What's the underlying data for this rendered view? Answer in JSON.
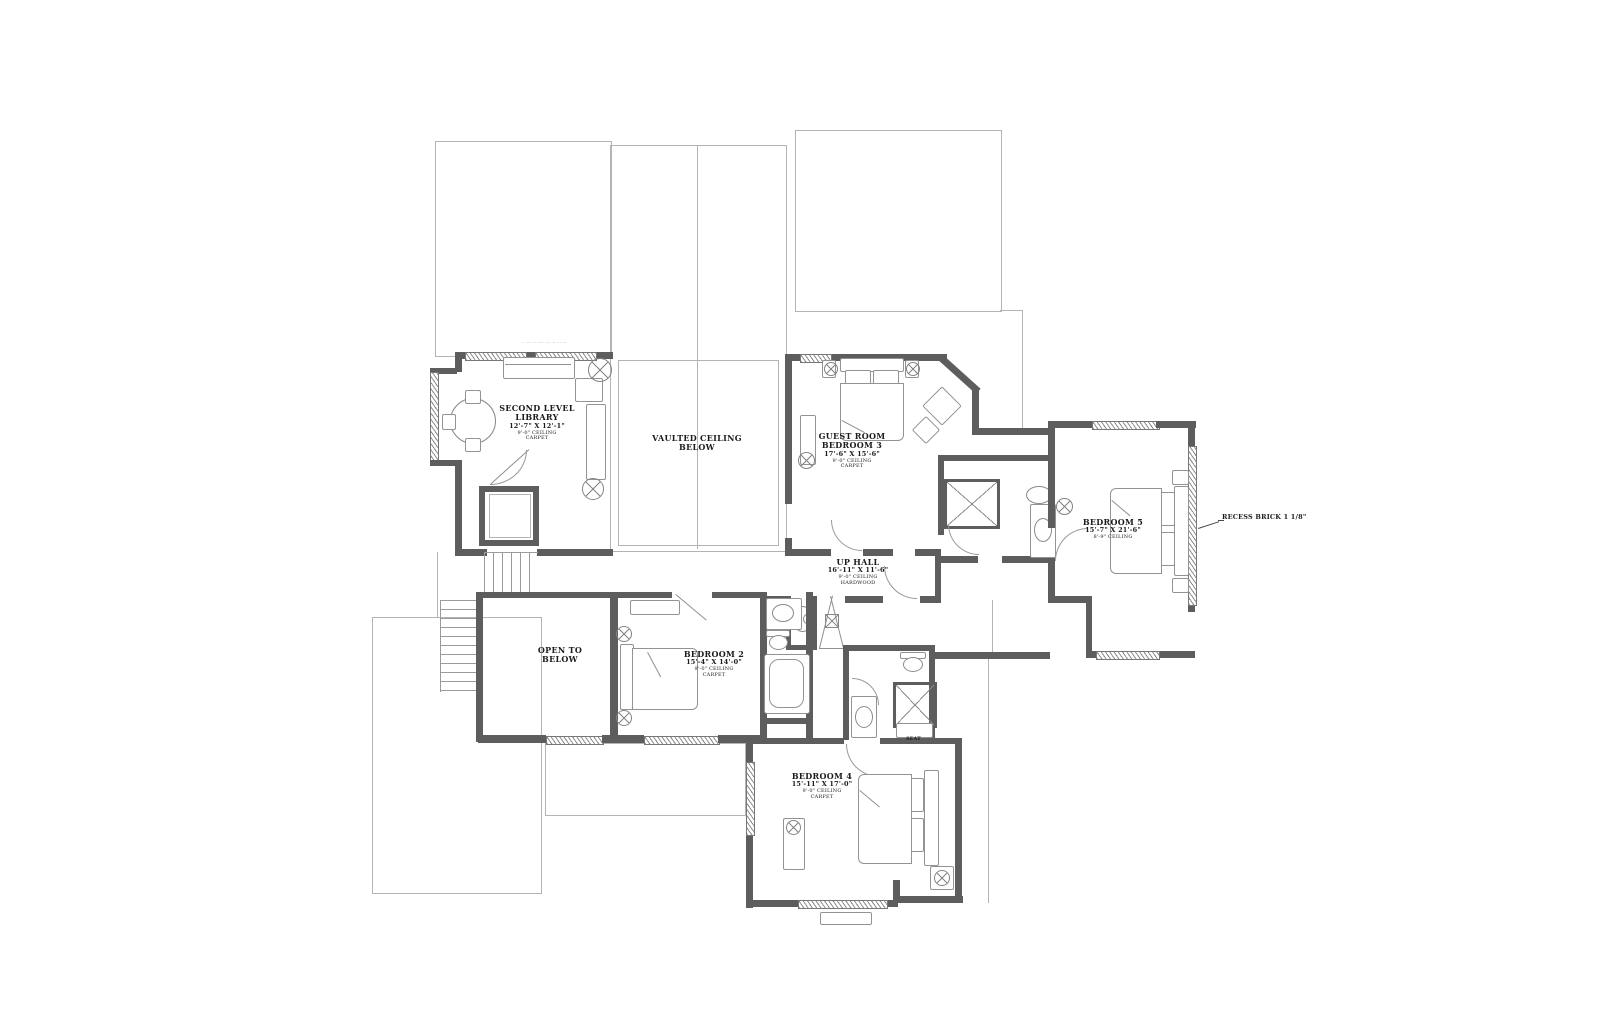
{
  "drawing": {
    "rooms": {
      "library": {
        "name1": "SECOND LEVEL",
        "name2": "LIBRARY",
        "dims": "12'-7\" X 12'-1\"",
        "ceiling": "9'-0\" CEILING",
        "floor": "CARPET"
      },
      "vaulted": {
        "name1": "VAULTED CEILING",
        "name2": "BELOW"
      },
      "guest": {
        "name1": "GUEST ROOM",
        "name2": "BEDROOM 3",
        "dims": "17'-6\" X 15'-6\"",
        "ceiling": "9'-0\" CEILING",
        "floor": "CARPET"
      },
      "bedroom5": {
        "name1": "BEDROOM 5",
        "dims": "15'-7\" X 21'-6\"",
        "ceiling": "8'-9\" CEILING"
      },
      "uphall": {
        "name1": "UP HALL",
        "dims": "16'-11\" X 11'-6\"",
        "ceiling": "9'-0\" CEILING",
        "floor": "HARDWOOD"
      },
      "open_below": {
        "name1": "OPEN TO",
        "name2": "BELOW"
      },
      "bedroom2": {
        "name1": "BEDROOM 2",
        "dims": "15'-4\" X 14'-0\"",
        "ceiling": "9'-0\" CEILING",
        "floor": "CARPET"
      },
      "bedroom4": {
        "name1": "BEDROOM 4",
        "dims": "15'-11\" X 17'-0\"",
        "ceiling": "9'-0\" CEILING",
        "floor": "CARPET"
      }
    },
    "annotations": {
      "recess_brick": "RECESS BRICK 1 1/8\"",
      "seat": "SEAT",
      "top_note": "·· ····· ··· ······ ···· ··· ·· ·····"
    },
    "colors": {
      "wall": "#5d5d5d",
      "thin": "#b4b4b4",
      "text": "#1c1c1c"
    }
  }
}
